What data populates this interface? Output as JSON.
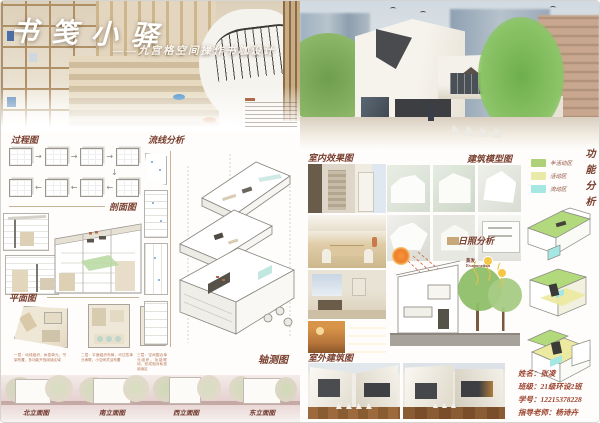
{
  "icons": {
    "arrow_right": "→",
    "arrow_left": "←",
    "arrow_down": "↓"
  },
  "left_panel": {
    "hero": {
      "title": "书笺小驿",
      "subtitle": "——九宫格空间操作书咖设计"
    },
    "process_label": "过程图",
    "circulation_label": "流线分析",
    "section_label": "剖面图",
    "plan_label": "平面图",
    "axon_label": "轴测图",
    "plan_captions": [
      "一层：动线组织，休息单元，书架布置，多功能开放阅读区域",
      "二层：平面组织布局，可达性单元串联，小空间灵活布置",
      "三层：空间围合单元组织，功能联动，形成相对私密阅读区"
    ],
    "elevation_labels": [
      "北立面图",
      "南立面图",
      "西立面图",
      "东立面图"
    ]
  },
  "right_panel": {
    "interior_label": "室内效果图",
    "model_label": "建筑模型图",
    "function_label": "功能分析",
    "legend": [
      {
        "label": "半活动区",
        "color": "#aed178"
      },
      {
        "label": "活动区",
        "color": "#e9e9a8"
      },
      {
        "label": "流动区",
        "color": "#a5e8e3"
      }
    ],
    "sun_label": "日照分析",
    "sun_annotation_cn": "蒸发",
    "sun_annotation_en": "Evaporation",
    "exterior_label": "室外建筑图",
    "credits": [
      "姓名：张凌",
      "班级：21级环设2班",
      "学号：12215378228",
      "指导老师：杨诗卉"
    ]
  }
}
